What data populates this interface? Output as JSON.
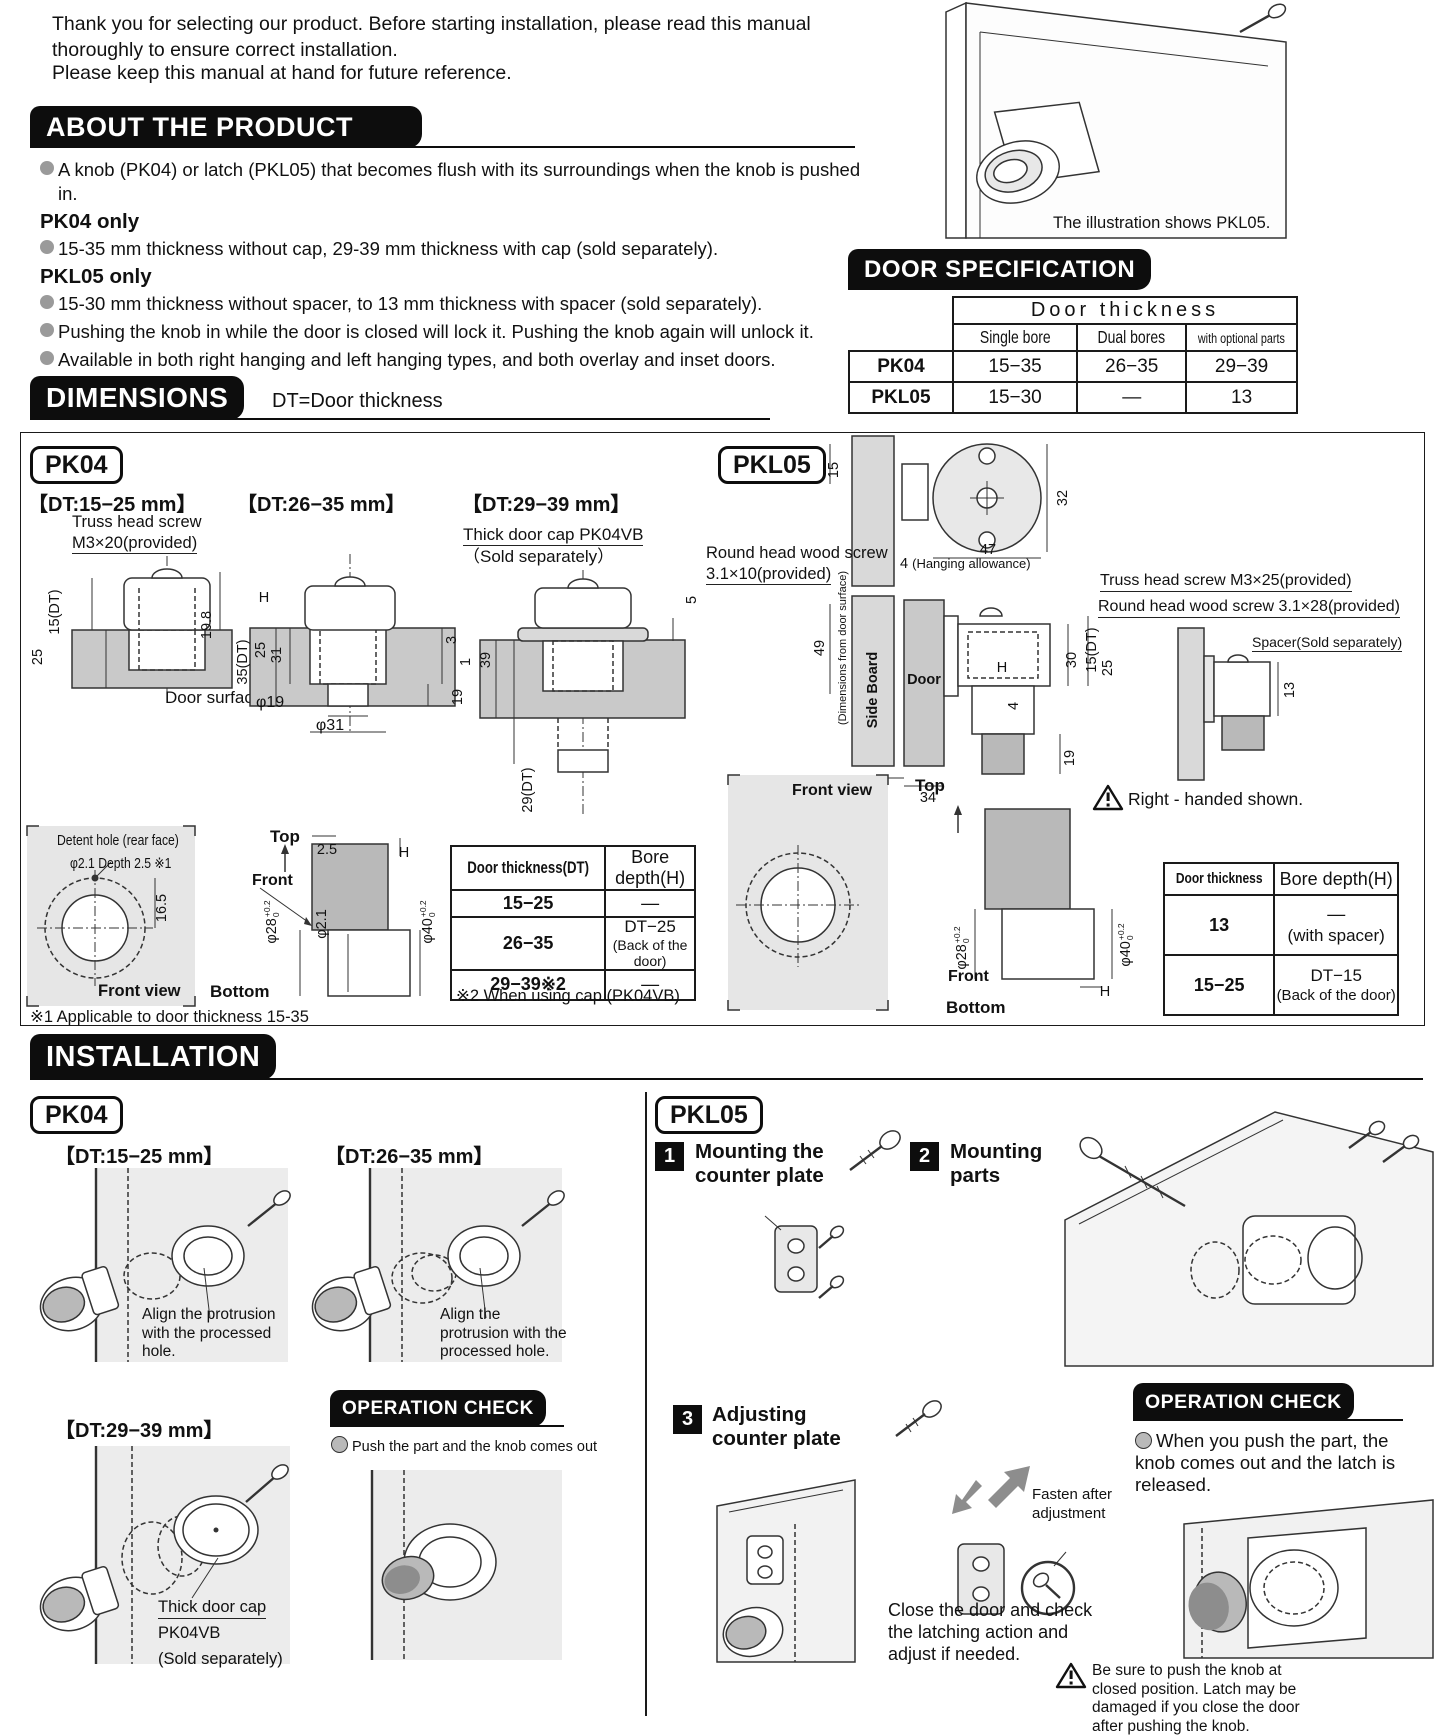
{
  "intro": {
    "text1": "Thank you for selecting our product. Before starting installation, please read this manual thoroughly to ensure correct installation.",
    "text2": "Please keep this manual at hand for future reference."
  },
  "about": {
    "title": "ABOUT THE PRODUCT",
    "bullets": [
      "A knob (PK04) or latch (PKL05) that becomes flush with its surroundings when the knob is pushed in.",
      "15-35 mm thickness without cap, 29-39 mm thickness with cap (sold separately).",
      "15-30 mm thickness without spacer, to 13 mm thickness with spacer (sold separately).",
      "Pushing the knob in while the door is closed will lock it. Pushing the knob again will unlock it.",
      "Available in both right hanging and left hanging types, and both overlay and inset doors."
    ],
    "pk04_heading": "PK04 only",
    "pkl05_heading": "PKL05 only",
    "illustration_caption": "The illustration shows PKL05."
  },
  "door_spec": {
    "title": "DOOR SPECIFICATION",
    "group": "Door thickness",
    "cols": [
      "Single bore",
      "Dual bores",
      "with optional parts"
    ],
    "rows": [
      {
        "model": "PK04",
        "c1": "15−35",
        "c2": "26−35",
        "c3": "29−39"
      },
      {
        "model": "PKL05",
        "c1": "15−30",
        "c2": "—",
        "c3": "13"
      }
    ]
  },
  "dimensions": {
    "title": "DIMENSIONS",
    "note": "DT=Door thickness",
    "pk04": {
      "label": "PK04",
      "dt1": "【DT:15−25 mm】",
      "dt2": "【DT:26−35 mm】",
      "dt3": "【DT:29−39 mm】",
      "truss1": "Truss head screw",
      "truss2": "M3×20(provided)",
      "cap1": "Thick door cap PK04VB",
      "cap2": "（Sold separately）",
      "door_surface": "Door surface",
      "d15dt": "15(DT)",
      "d25a": "25",
      "d198": "19.8",
      "dH": "H",
      "d35dt": "35(DT)",
      "d25b": "25",
      "d31": "31",
      "d3": "3",
      "d1": "1",
      "d19": "19",
      "phi19": "φ19",
      "phi31": "φ31",
      "d5": "5",
      "d39": "39",
      "d29dt": "29(DT)",
      "detent1": "Detent hole (rear face)",
      "detent2": "φ2.1 Depth 2.5 ※1",
      "d165": "16.5",
      "front_view": "Front view",
      "top": "Top",
      "front": "Front",
      "bottom": "Bottom",
      "d25c": "2.5",
      "dHb": "H",
      "phi28": "φ28",
      "phi21": "φ2.1",
      "phi40": "φ40",
      "tol_top": "+0.2",
      "tol_bot": "0",
      "bore": {
        "h1": "Door thickness(DT)",
        "h2": "Bore depth(H)",
        "rows": [
          {
            "dt": "15−25",
            "v": "—",
            "v2": ""
          },
          {
            "dt": "26−35",
            "v": "DT−25",
            "v2": "(Back of the door)"
          },
          {
            "dt": "29−39※2",
            "v": "—",
            "v2": ""
          }
        ]
      },
      "note2": "※2 When using cap (PK04VB)",
      "note1": "※1 Applicable to door thickness 15-35"
    },
    "pkl05": {
      "label": "PKL05",
      "d15": "15",
      "d32": "32",
      "d47": "47",
      "d4a": "4",
      "hanging": "(Hanging allowance)",
      "wood1a": "Round head wood screw",
      "wood1b": "3.1×10(provided)",
      "truss": "Truss head screw M3×25(provided)",
      "wood2": "Round head wood screw 3.1×28(provided)",
      "spacer": "Spacer(Sold separately)",
      "d49": "49",
      "dims_from": "(Dimensions from door surface)",
      "side_board": "Side Board",
      "door": "Door",
      "dH": "H",
      "d30": "30",
      "d15dt": "15(DT)",
      "d25": "25",
      "d4b": "4",
      "d19": "19",
      "d2": "2",
      "d34": "34",
      "d13": "13",
      "warning": "Right - handed shown.",
      "front_view": "Front view",
      "top": "Top",
      "front": "Front",
      "bottom": "Bottom",
      "phi28": "φ28",
      "phi40": "φ40",
      "tol_top": "+0.2",
      "tol_bot": "0",
      "dHb": "H",
      "bore": {
        "h1": "Door thickness",
        "h2": "Bore depth(H)",
        "rows": [
          {
            "dt": "13",
            "v": "—",
            "v2": "(with spacer)"
          },
          {
            "dt": "15−25",
            "v": "DT−15",
            "v2": "(Back of the door)"
          }
        ]
      }
    }
  },
  "installation": {
    "title": "INSTALLATION",
    "pk04": {
      "label": "PK04",
      "dt1": "【DT:15−25 mm】",
      "dt2": "【DT:26−35 mm】",
      "dt3": "【DT:29−39 mm】",
      "align1": "Align the protrusion with the processed hole.",
      "align2": "Align the protrusion with the processed hole.",
      "cap1": "Thick door cap",
      "cap2": "PK04VB",
      "cap3": "(Sold separately)",
      "opcheck_title": "OPERATION CHECK",
      "opcheck_note": "Push the part and the knob comes out"
    },
    "pkl05": {
      "label": "PKL05",
      "steps": [
        {
          "num": "1",
          "text": "Mounting the counter plate"
        },
        {
          "num": "2",
          "text": "Mounting parts"
        },
        {
          "num": "3",
          "text": "Adjusting counter plate"
        }
      ],
      "fasten": "Fasten after adjustment",
      "close_note": "Close the door and check the latching action and adjust if needed.",
      "opcheck_title": "OPERATION CHECK",
      "opcheck_note": "When you push the part, the knob comes out and the latch is released.",
      "warning": "Be sure to push the knob at closed position. Latch may be damaged if you close the door after pushing the knob."
    }
  }
}
